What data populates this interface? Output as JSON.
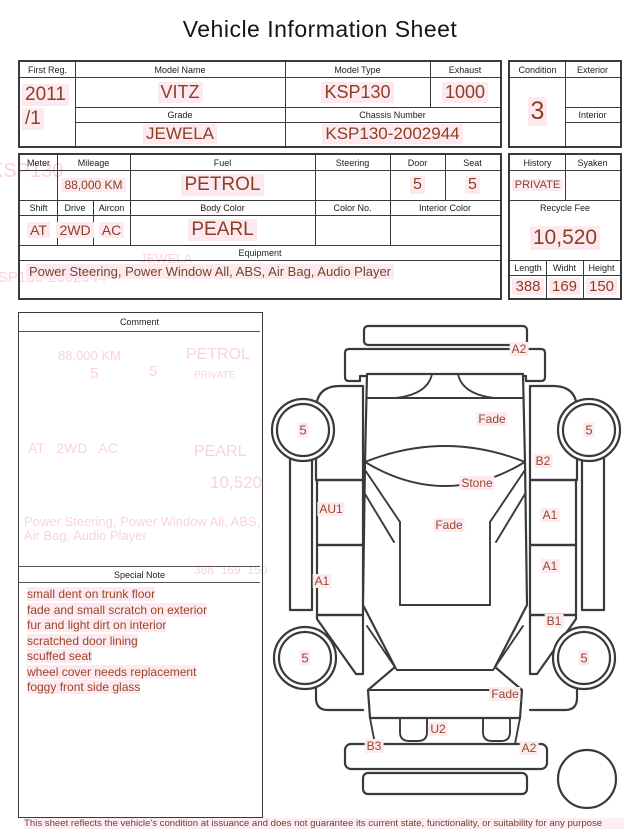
{
  "title": "Vehicle Information Sheet",
  "reg_table": {
    "first_reg_label": "First Reg.",
    "first_reg_line1": "2011",
    "first_reg_line2": "/1",
    "model_name_label": "Model Name",
    "model_name": "VITZ",
    "model_type_label": "Model Type",
    "model_type": "KSP130",
    "exhaust_label": "Exhaust",
    "exhaust": "1000",
    "grade_label": "Grade",
    "grade": "JEWELA",
    "chassis_label": "Chassis Number",
    "chassis": "KSP130-2002944"
  },
  "condition_table": {
    "condition_label": "Condition",
    "condition": "3",
    "exterior_label": "Exterior",
    "exterior": "",
    "interior_label": "Interior",
    "interior": ""
  },
  "spec_table": {
    "meter_label": "Meter",
    "meter": "",
    "mileage_label": "Mileage",
    "mileage": "88,000 KM",
    "fuel_label": "Fuel",
    "fuel": "PETROL",
    "steering_label": "Steering",
    "steering": "",
    "door_label": "Door",
    "door": "5",
    "seat_label": "Seat",
    "seat": "5",
    "shift_label": "Shift",
    "shift": "AT",
    "drive_label": "Drive",
    "drive": "2WD",
    "aircon_label": "Aircon",
    "aircon": "AC",
    "body_color_label": "Body Color",
    "body_color": "PEARL",
    "color_no_label": "Color No.",
    "color_no": "",
    "interior_color_label": "Interior Color",
    "interior_color": "",
    "equipment_label": "Equipment",
    "equipment": "Power Steering, Power Window  All, ABS, Air Bag, Audio Player"
  },
  "history_table": {
    "history_label": "History",
    "history": "PRIVATE",
    "syaken_label": "Syaken",
    "syaken": "",
    "recycle_fee_label": "Recycle Fee",
    "recycle_fee": "10,520",
    "length_label": "Length",
    "length": "388",
    "width_label": "Widht",
    "width": "169",
    "height_label": "Height",
    "height": "150"
  },
  "comment": {
    "header": "Comment",
    "body": ""
  },
  "special_note": {
    "header": "Special Note",
    "lines": [
      "small dent on trunk floor",
      "fade and small scratch on exterior",
      "fur and light dirt on interior",
      "scratched door lining",
      "scuffed seat",
      "wheel cover needs replacement",
      "foggy front side glass"
    ]
  },
  "diagram": {
    "labels": [
      "A2",
      "Fade",
      "5",
      "5",
      "B2",
      "Stone",
      "AU1",
      "A1",
      "Fade",
      "A1",
      "A1",
      "B1",
      "5",
      "5",
      "Fade",
      "U2",
      "B3",
      "A2"
    ]
  },
  "ghost_texts": [
    "KSP130",
    "KSP130-2002944",
    "JEWELA",
    "88,000 KM",
    "PETROL",
    "5",
    "5",
    "PRIVATE",
    "AT   2WD   AC",
    "PEARL",
    "10,520",
    "Power Steering, Power Window  All, ABS, Air Bag, Audio Player",
    "388  169  150"
  ],
  "footer": "This sheet reflects the vehicle's condition at issuance and does not guarantee its current state, functionality, or suitability for any purpose",
  "colors": {
    "value_text": "#8d3f24",
    "highlight": "#fceaf0",
    "line": "#3a3a3a",
    "ghost": "#f6aec4"
  }
}
